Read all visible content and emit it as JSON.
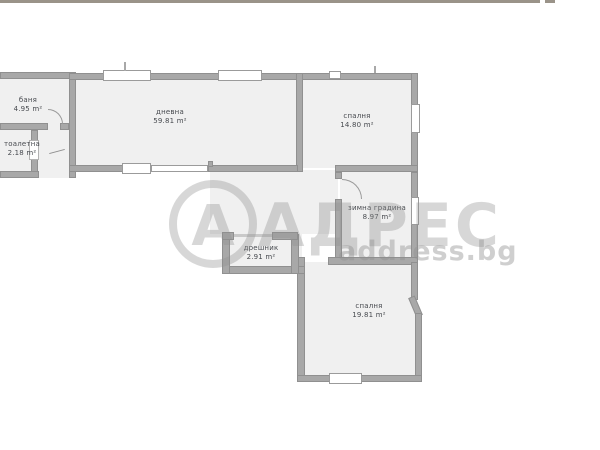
{
  "plan": {
    "rooms": [
      {
        "id": "banya",
        "name": "баня",
        "area": "4.95 m²"
      },
      {
        "id": "toaletna",
        "name": "тоалетна",
        "area": "2.18 m²"
      },
      {
        "id": "dnevna",
        "name": "дневна",
        "area": "59.81 m²"
      },
      {
        "id": "spalnya_top",
        "name": "спалня",
        "area": "14.80 m²"
      },
      {
        "id": "zimna_gradina",
        "name": "зимна градина",
        "area": "8.97 m²"
      },
      {
        "id": "dreshnik",
        "name": "дрешник",
        "area": "2.91 m²"
      },
      {
        "id": "spalnya_bottom",
        "name": "спалня",
        "area": "19.81 m²"
      }
    ],
    "watermark": {
      "logo_letter": "А",
      "brand": "АДРЕС",
      "domain": "address.bg"
    },
    "colors": {
      "top_bar": "#9a9389",
      "wall": "#a8a8a8",
      "room_fill": "#f0f0f0",
      "label_text": "#474a4f",
      "watermark": "#8f8f8f"
    }
  }
}
